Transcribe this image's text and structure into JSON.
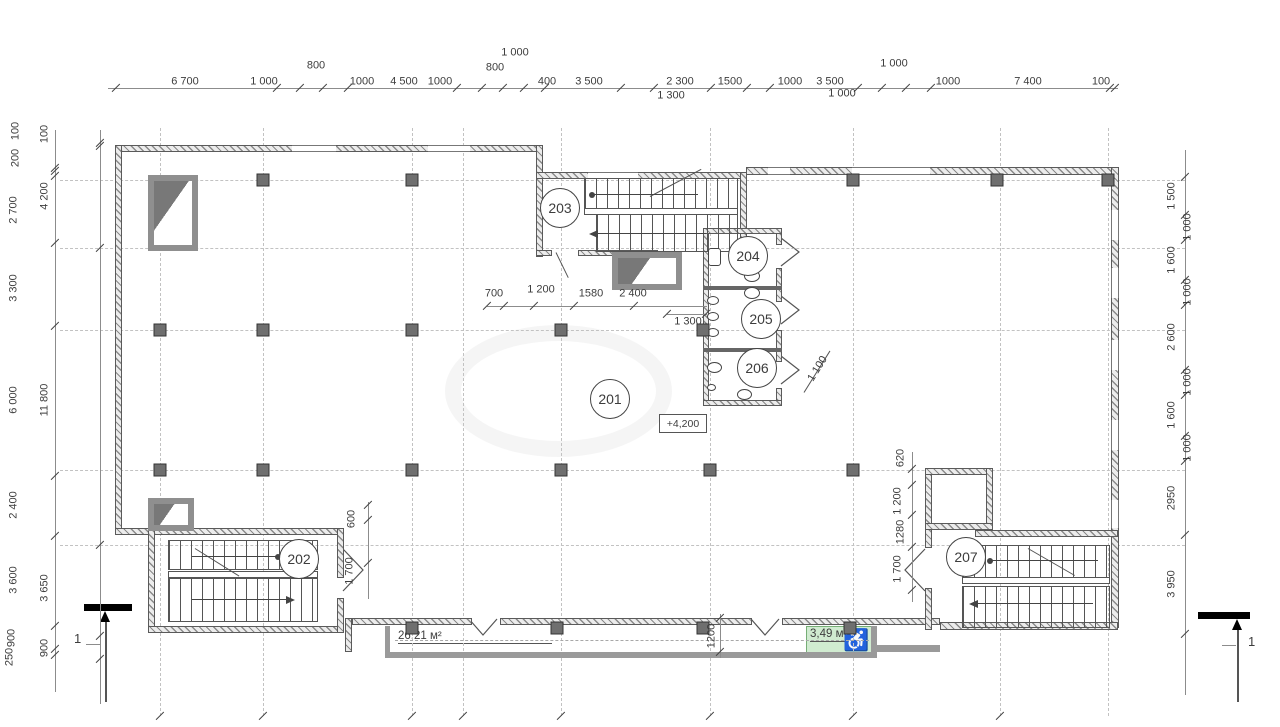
{
  "drawing": {
    "rooms": [
      {
        "number": "201"
      },
      {
        "number": "202"
      },
      {
        "number": "203"
      },
      {
        "number": "204"
      },
      {
        "number": "205"
      },
      {
        "number": "206"
      },
      {
        "number": "207"
      }
    ],
    "elevation_mark": "+4,200",
    "area_labels": {
      "balcony": "26,21 м²",
      "accessible": "3,49 м²"
    },
    "section_mark": "1",
    "icons": {
      "wheelchair": "♿"
    },
    "dimensions": {
      "top_main": [
        "6 700",
        "1 000",
        "1000",
        "4 500",
        "1000",
        "400",
        "3 500",
        "2 300",
        "1500",
        "1000",
        "3 500",
        "1000",
        "7 400",
        "100"
      ],
      "top_upper": [
        "800",
        "800",
        "1 000",
        "1 000"
      ],
      "top_below": [
        "1 300",
        "1 000"
      ],
      "left_outer": [
        "100",
        "200",
        "2 700",
        "3 300",
        "6 000",
        "2 400",
        "3 600",
        "900",
        "250"
      ],
      "left_inner": [
        "100",
        "4 200",
        "11 800",
        "3 650",
        "900"
      ],
      "right_side": [
        "1 500",
        "1 000",
        "1 600",
        "1 000",
        "2 600",
        "1 000",
        "1 600",
        "1 000",
        "2950",
        "3 950"
      ],
      "interior_top": [
        "700",
        "1 200",
        "1580",
        "2 400"
      ],
      "interior_top_below": "1 300",
      "wc_side": "1 100",
      "stair202_side": [
        "600",
        "1 700"
      ],
      "stair207_side": [
        "620",
        "1 200",
        "1280",
        "1 700"
      ],
      "balcony_door": "1200"
    }
  }
}
